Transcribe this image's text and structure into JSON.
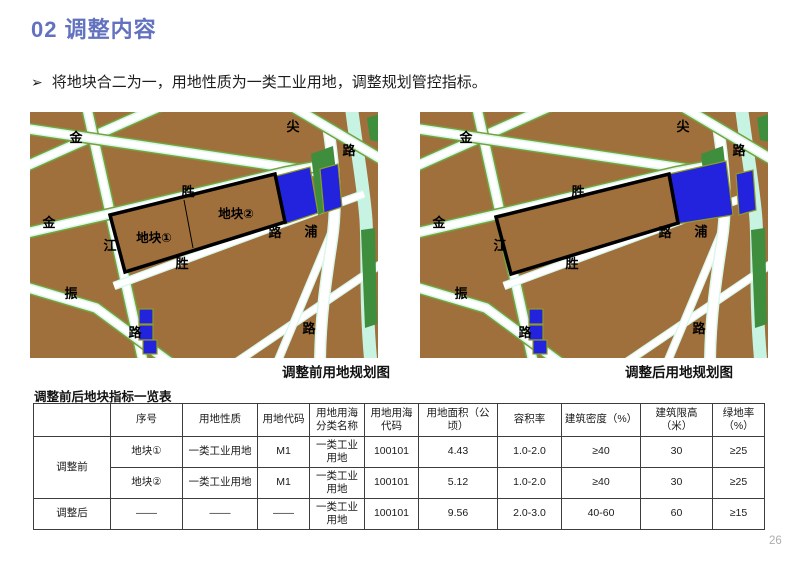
{
  "header": {
    "title": "02 调整内容",
    "title_color": "#6272BE"
  },
  "bullet": {
    "marker": "➢",
    "text": "将地块合二为一，用地性质为一类工业用地，调整规划管控指标。"
  },
  "maps": {
    "colors": {
      "land_brown": "#A0703C",
      "road_white": "#FFFFFF",
      "canal_cyan": "#D9F7EA",
      "green_strip": "#75A23C",
      "park_green": "#3E8E3E",
      "water_blue": "#2323DD",
      "plot_outline": "#000000"
    },
    "before": {
      "caption": "调整前用地规划图",
      "plot1_label": "地块①",
      "plot2_label": "地块②",
      "road_labels": [
        "金",
        "尖",
        "路",
        "胜",
        "金",
        "江",
        "路",
        "浦",
        "胜",
        "振",
        "路",
        "路"
      ]
    },
    "after": {
      "caption": "调整后用地规划图",
      "road_labels": [
        "金",
        "尖",
        "路",
        "胜",
        "金",
        "江",
        "路",
        "浦",
        "胜",
        "振",
        "路",
        "路"
      ]
    }
  },
  "table": {
    "title": "调整前后地块指标一览表",
    "headers": [
      "",
      "序号",
      "用地性质",
      "用地代码",
      "用地用海分类名称",
      "用地用海代码",
      "用地面积（公顷）",
      "容积率",
      "建筑密度（%）",
      "建筑限高（米）",
      "绿地率（%）"
    ],
    "rows": [
      {
        "group": "调整前",
        "cells": [
          "地块①",
          "一类工业用地",
          "M1",
          "一类工业用地",
          "100101",
          "4.43",
          "1.0-2.0",
          "≥40",
          "30",
          "≥25"
        ]
      },
      {
        "group": "",
        "cells": [
          "地块②",
          "一类工业用地",
          "M1",
          "一类工业用地",
          "100101",
          "5.12",
          "1.0-2.0",
          "≥40",
          "30",
          "≥25"
        ]
      },
      {
        "group": "调整后",
        "cells": [
          "——",
          "——",
          "——",
          "一类工业用地",
          "100101",
          "9.56",
          "2.0-3.0",
          "40-60",
          "60",
          "≥15"
        ]
      }
    ]
  },
  "page": {
    "number": "26"
  }
}
